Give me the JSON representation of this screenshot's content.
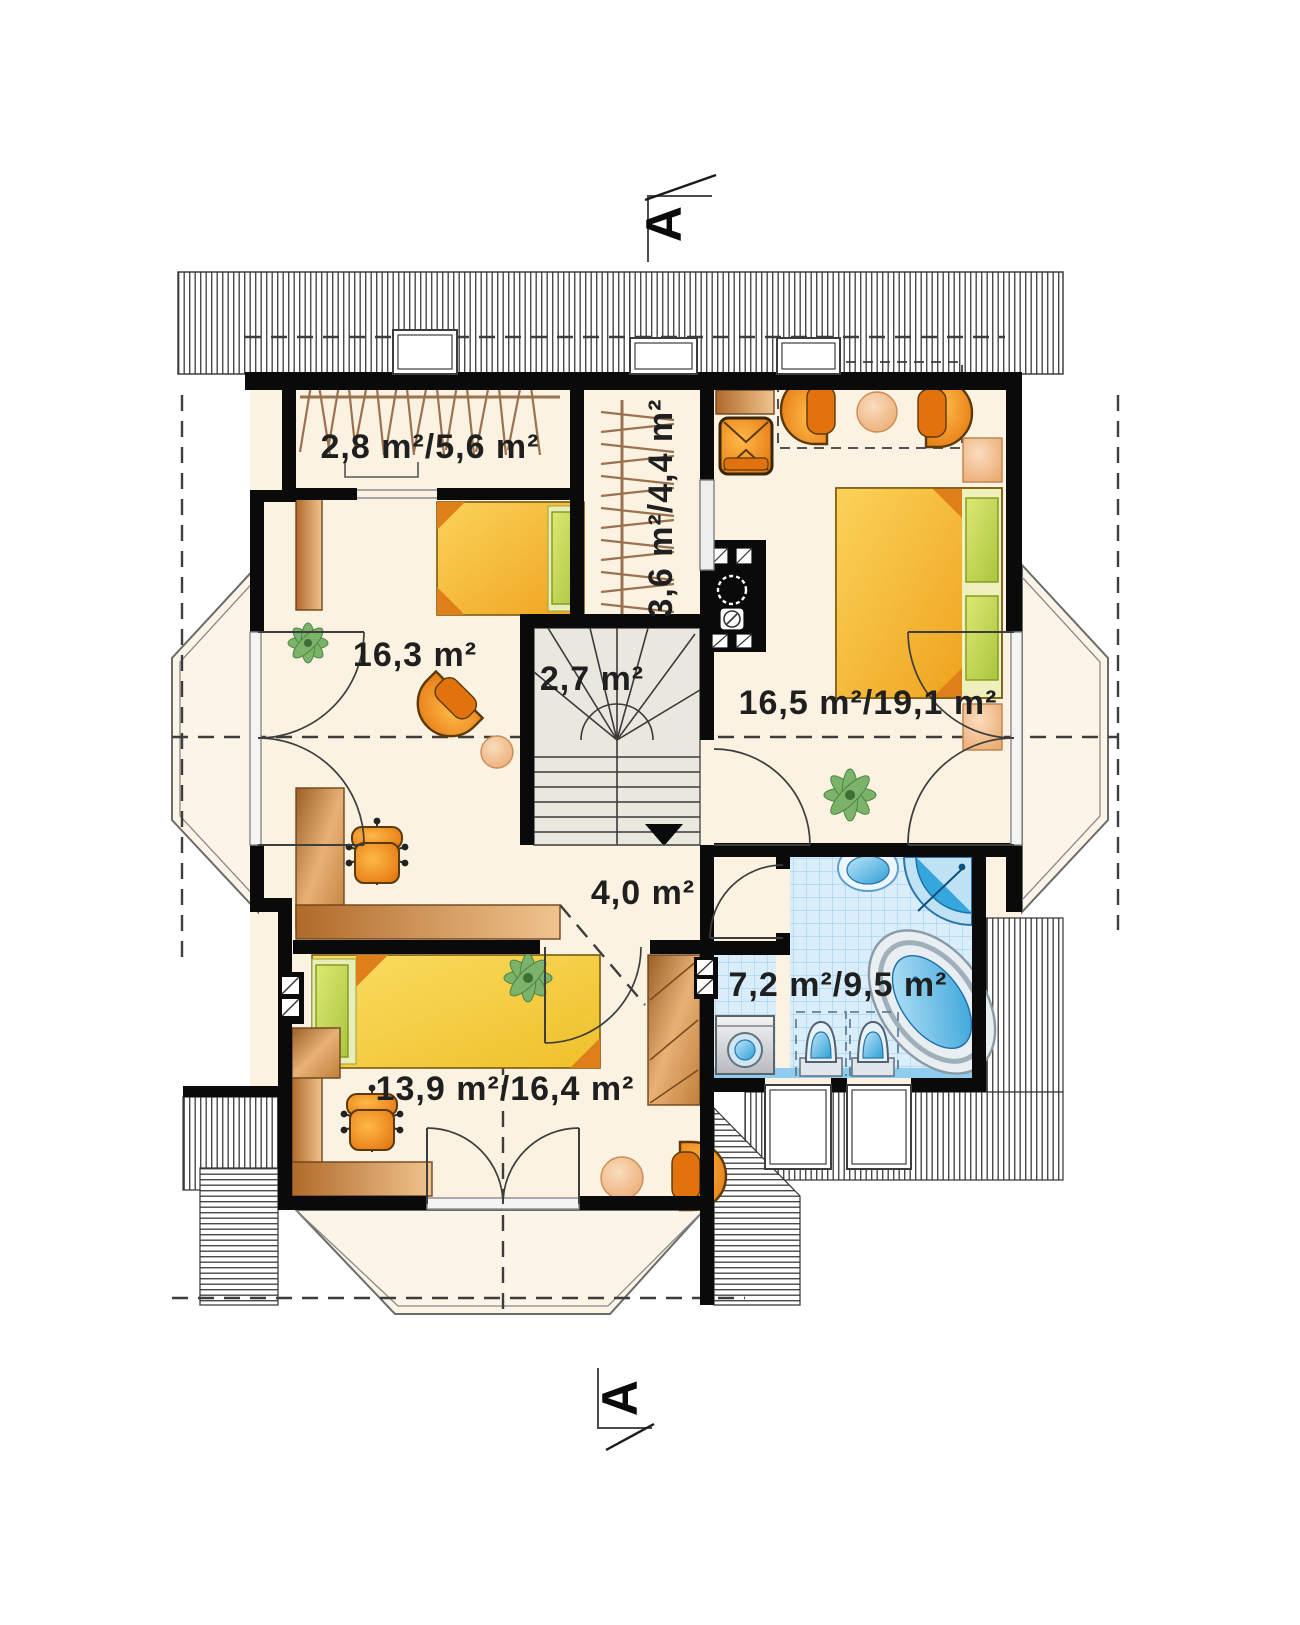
{
  "plan": {
    "title": "attic-floor-plan",
    "section_marker": {
      "label": "A"
    },
    "rooms": {
      "wardrobe": {
        "area_label": "2,8 m²/5,6 m²"
      },
      "closet": {
        "area_label": "3,6 m²/4,4 m²"
      },
      "living": {
        "area_label": "16,3 m²"
      },
      "stairs": {
        "area_label": "2,7 m²"
      },
      "bedroom": {
        "area_label": "16,5 m²/19,1 m²"
      },
      "hall": {
        "area_label": "4,0 m²"
      },
      "bathroom": {
        "area_label": "7,2 m²/9,5 m²"
      },
      "child_room": {
        "area_label": "13,9 m²/16,4 m²"
      }
    },
    "colors": {
      "wall": "#0a0a0a",
      "floor": "#fbf2e2",
      "tile_blue": "#d9edfb",
      "fixture_blue": "#35a7dd",
      "furniture_orange": "#f08c1e",
      "bed_yellow": "#f5b92c",
      "pillow_green": "#bcd24e",
      "wood": "#c9853f",
      "stair_grey": "#eae7de",
      "label_text": "#1f1f1f"
    }
  }
}
